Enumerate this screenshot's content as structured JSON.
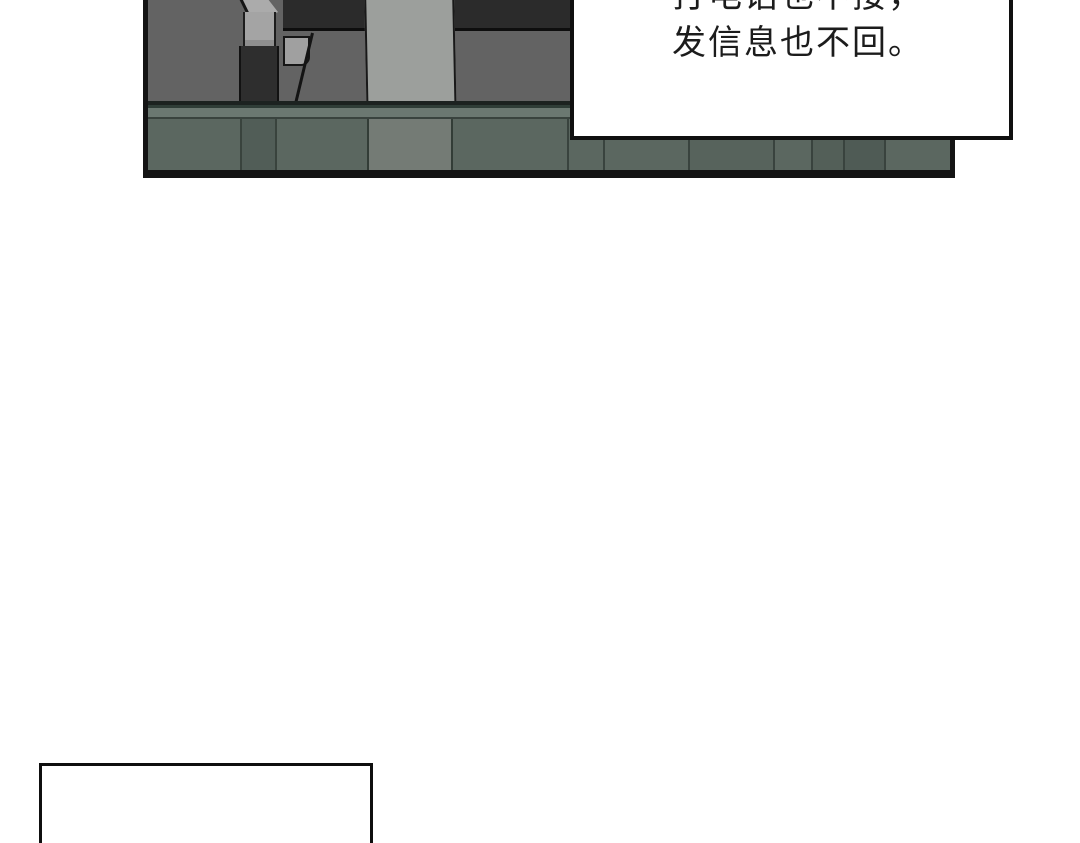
{
  "speech_bubble": {
    "lines": [
      "打电话也不接，",
      "发信息也不回。"
    ],
    "text_color": "#1c1c1c",
    "fill": "#ffffff",
    "border_color": "#101010"
  },
  "panel": {
    "border_color": "#141414",
    "wall_color": "#636363",
    "table_color": "#2b2b2b",
    "chair_light_color": "#a4a4a4",
    "chair_dark_color": "#2e2e2e",
    "pillar_color": "#9c9f9c",
    "floor_band_color": "#6b7871",
    "floor_base_color": "#5b6760",
    "floor_dark_stripe_color": "#515d57",
    "floor_light_stripe_color": "#747b75"
  },
  "bottom_panel": {
    "fill": "#ffffff",
    "border_color": "#0f0f0f"
  }
}
